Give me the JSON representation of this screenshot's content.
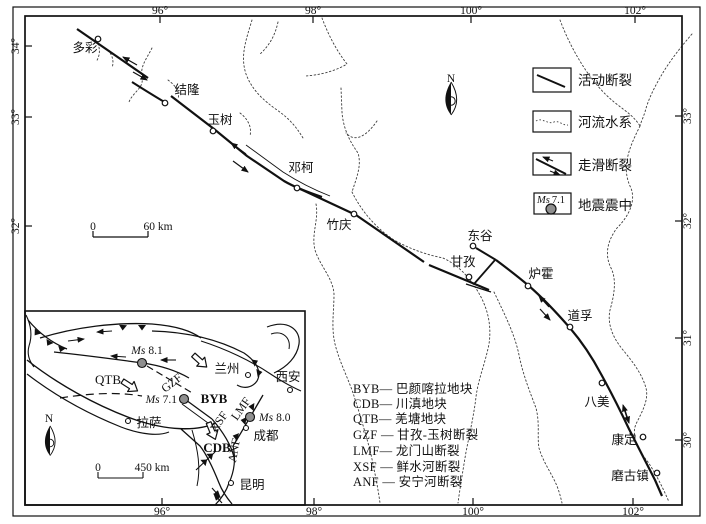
{
  "figure_title": "甘孜-玉树断裂带构造图",
  "axes": {
    "top": [
      "96°",
      "98°",
      "100°",
      "102°"
    ],
    "bottom": [
      "96°",
      "98°",
      "100°",
      "102°"
    ],
    "left": [
      "34°",
      "33°",
      "32°"
    ],
    "right": [
      "33°",
      "32°",
      "31°",
      "30°"
    ]
  },
  "main_map": {
    "north_label": "N",
    "scale_bar": {
      "zero": "0",
      "label": "60 km"
    },
    "cities": [
      {
        "name": "多彩"
      },
      {
        "name": "结隆"
      },
      {
        "name": "玉树"
      },
      {
        "name": "邓柯"
      },
      {
        "name": "竹庆"
      },
      {
        "name": "东谷"
      },
      {
        "name": "甘孜"
      },
      {
        "name": "炉霍"
      },
      {
        "name": "道孚"
      },
      {
        "name": "八美"
      },
      {
        "name": "康定"
      },
      {
        "name": "磨古镇"
      }
    ]
  },
  "legend": {
    "items": [
      {
        "label": "活动断裂"
      },
      {
        "label": "河流水系"
      },
      {
        "label": "走滑断裂"
      },
      {
        "label": "地震震中",
        "symbol_prefix": "Ms",
        "symbol_value": "7.1"
      }
    ]
  },
  "abbreviations": [
    {
      "abbr": "BYB",
      "sep": "— ",
      "name": "巴颜喀拉地块"
    },
    {
      "abbr": "CDB",
      "sep": "— ",
      "name": "川滇地块"
    },
    {
      "abbr": "QTB",
      "sep": "— ",
      "name": "羌塘地块"
    },
    {
      "abbr": "GZF",
      "sep": " — ",
      "name": "甘孜-玉树断裂"
    },
    {
      "abbr": "LMF",
      "sep": "— ",
      "name": "龙门山断裂"
    },
    {
      "abbr": "XSF",
      "sep": " — ",
      "name": "鲜水河断裂"
    },
    {
      "abbr": "ANF",
      "sep": " — ",
      "name": "安宁河断裂"
    }
  ],
  "inset": {
    "north_label": "N",
    "scale_bar": {
      "zero": "0",
      "label": "450 km"
    },
    "cities": [
      {
        "name": "兰州"
      },
      {
        "name": "西安"
      },
      {
        "name": "拉萨"
      },
      {
        "name": "成都"
      },
      {
        "name": "昆明"
      }
    ],
    "blocks": [
      {
        "code": "QTB"
      },
      {
        "code": "BYB"
      },
      {
        "code": "CDB"
      }
    ],
    "fault_labels": [
      {
        "code": "GZF"
      },
      {
        "code": "XSF"
      },
      {
        "code": "LMF"
      },
      {
        "code": "ANF"
      }
    ],
    "epicenters": [
      {
        "prefix": "Ms",
        "value": "8.1"
      },
      {
        "prefix": "Ms",
        "value": "7.1"
      },
      {
        "prefix": "Ms",
        "value": "8.0"
      }
    ]
  },
  "colors": {
    "line": "#111111",
    "epicenter_fill": "#8f8f8f",
    "river": "#3d3d3d"
  }
}
